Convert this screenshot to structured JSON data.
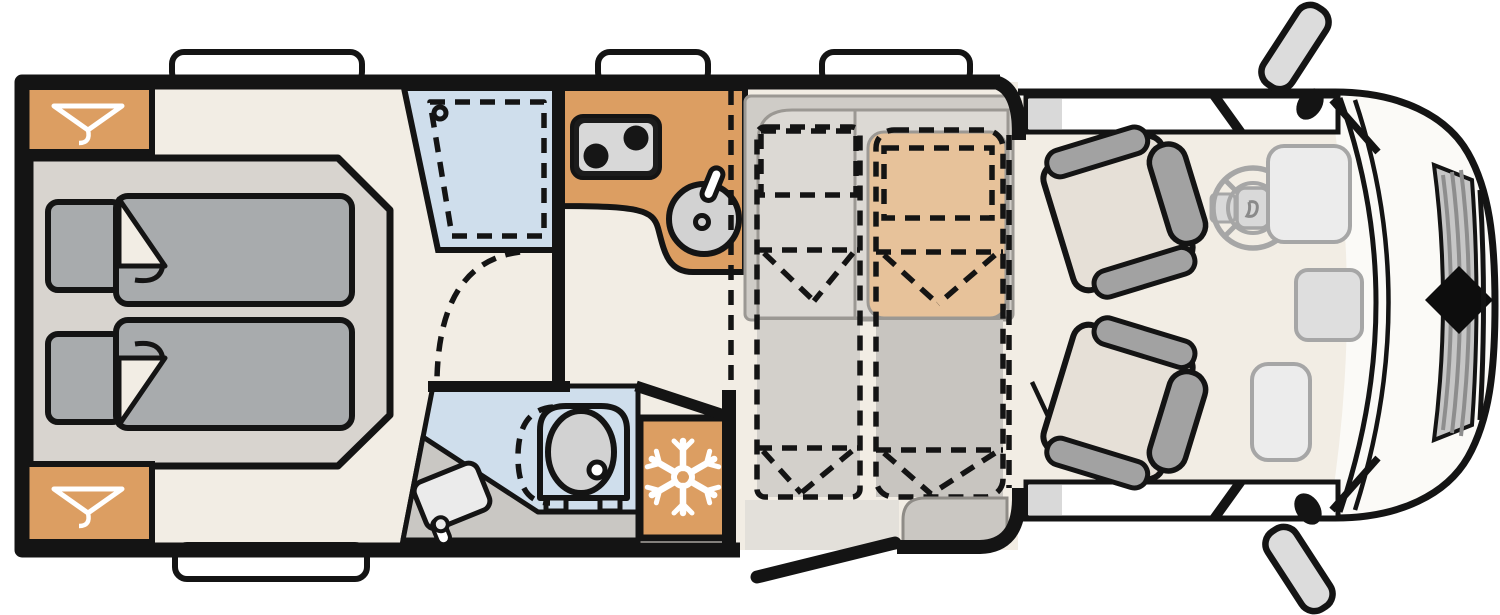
{
  "title": "Motorhome floor plan — top view",
  "palette": {
    "line_black": "#141414",
    "cab_body": "#fbfaf7",
    "floor_beige": "#f2ede4",
    "bed_platform": "#d8d4cf",
    "bedding_gray": "#a8abad",
    "accent_orange": "#dc9e62",
    "wetroom_blue": "#cfdeec",
    "fixture_gray": "#d2d2d2",
    "bath_counter": "#c9c7c3",
    "bench_gray": "#cfccc7",
    "bench_seat": "#dcd9d4",
    "bench_tan": "#e7c29a",
    "dropbed_pillow": "#b6b2ad",
    "dropbed_left": "#d3d0cb",
    "dropbed_right": "#c8c5c0",
    "entry_step": "#e3e0da",
    "door_bench": "#cac7c2",
    "cab_seat": "#e6e0d7",
    "seat_trim": "#a2a2a2",
    "mirror_gray": "#dcdcdc",
    "grille_gray": "#c6c6c6",
    "dash_item": "#ececec",
    "dash_item2": "#dedede",
    "stove_black": "#1c1c1c",
    "stove_face": "#d8d8d8",
    "icon_white": "#ffffff"
  },
  "rooms": {
    "bedroom": {
      "name": "rear-bedroom",
      "features": [
        "wardrobe-top",
        "wardrobe-bottom",
        "twin-bed-upper",
        "twin-bed-lower"
      ]
    },
    "washroom": {
      "name": "washroom",
      "features": [
        "shower",
        "toilet",
        "washbasin",
        "vanity-counter"
      ]
    },
    "kitchen": {
      "name": "kitchen",
      "features": [
        "two-burner-stove",
        "round-sink",
        "refrigerator"
      ]
    },
    "lounge": {
      "name": "dinette-lounge",
      "features": [
        "l-bench",
        "tan-bench",
        "drop-down-bed-left",
        "drop-down-bed-right"
      ]
    },
    "cab": {
      "name": "driver-cab",
      "features": [
        "driver-seat",
        "passenger-seat",
        "steering-wheel",
        "dashboard",
        "side-mirrors"
      ]
    },
    "entry": {
      "name": "entrance",
      "features": [
        "open-door",
        "entry-step"
      ]
    }
  },
  "icons": {
    "hanger": "clothes-hanger-icon",
    "snowflake": "fridge-freezer-icon",
    "steering": "steering-wheel-icon",
    "badge": "front-badge-diamond"
  },
  "counts": {
    "windows_top": 3,
    "windows_bottom": 1,
    "berths_drop_down": 2,
    "berths_rear": 2
  }
}
